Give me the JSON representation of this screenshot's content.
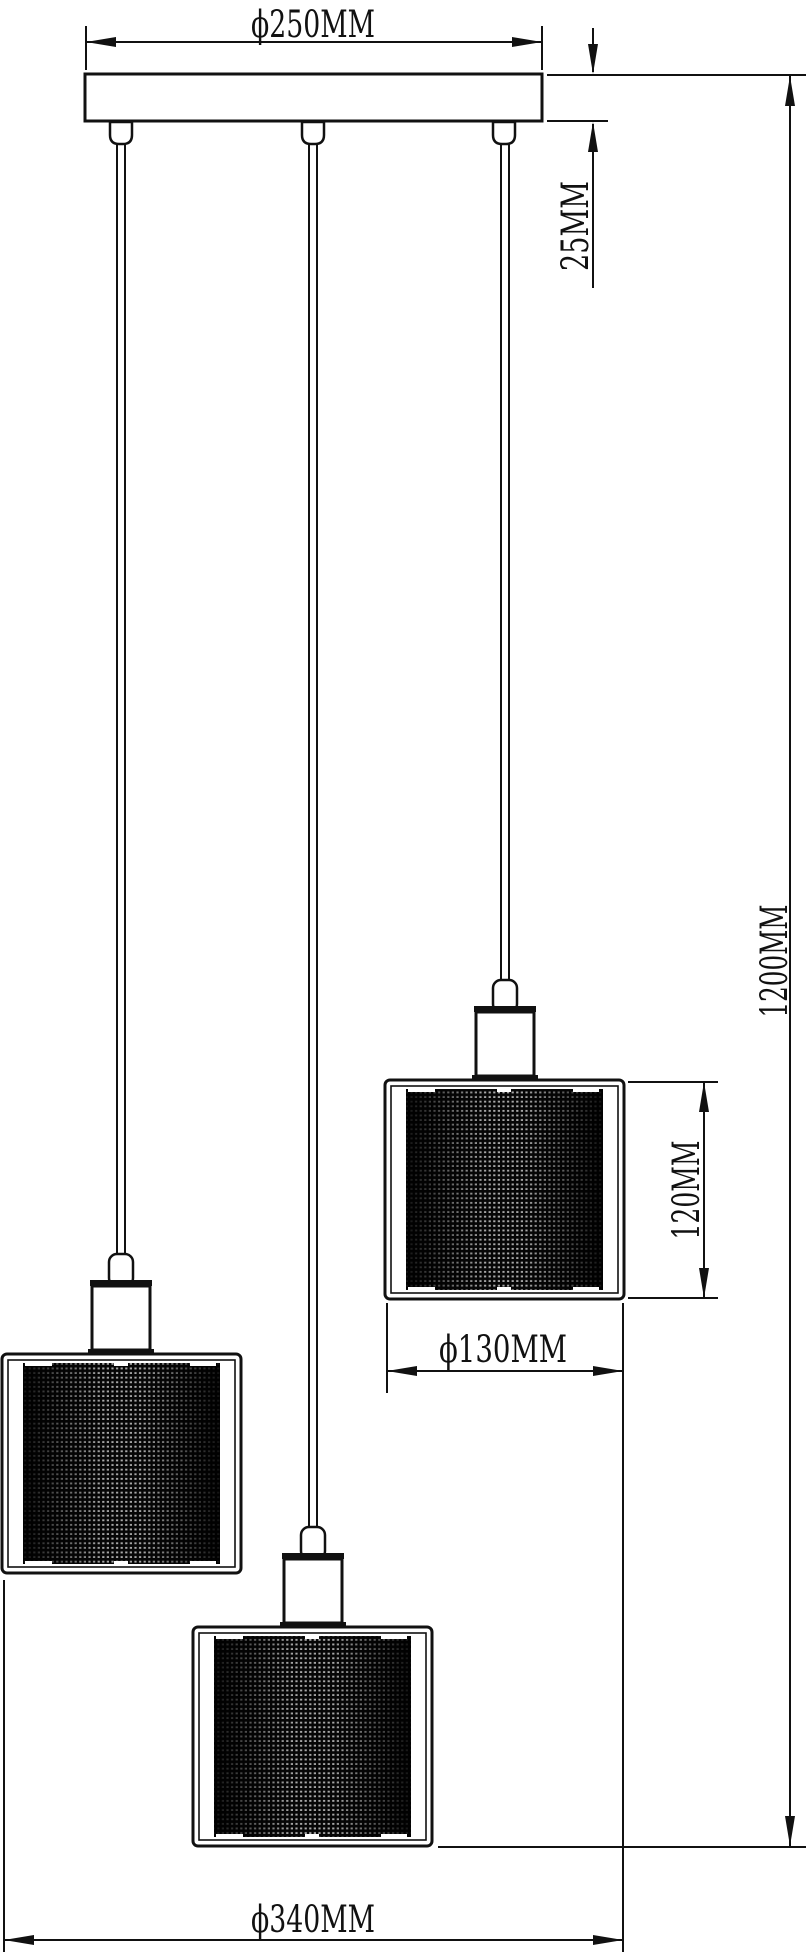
{
  "dims": {
    "canopy_width": {
      "label": "ϕ250MM"
    },
    "canopy_height": {
      "label": "25MM"
    },
    "total_drop": {
      "label": "1200MM"
    },
    "shade_height": {
      "label": "120MM"
    },
    "shade_width": {
      "label": "ϕ130MM"
    },
    "overall_width": {
      "label": "ϕ340MM"
    }
  },
  "colors": {
    "line": "#111111",
    "background": "#ffffff",
    "mesh_base": "#060606",
    "mesh_dot": "#a8a8a8"
  }
}
